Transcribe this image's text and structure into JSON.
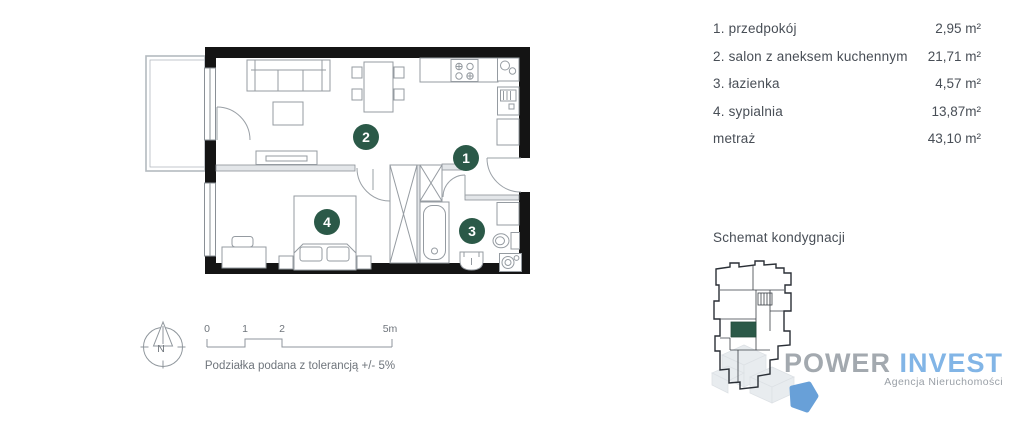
{
  "colors": {
    "accent_green": "#2b5948",
    "wall_black": "#141414",
    "furniture_gray": "#959ba1",
    "logo_gray": "#a3a9af",
    "logo_blue": "#82b5e6",
    "schematic_blue_shape": "#68a0d8"
  },
  "plan": {
    "room_markers": [
      {
        "num": "1"
      },
      {
        "num": "2"
      },
      {
        "num": "3"
      },
      {
        "num": "4"
      }
    ]
  },
  "legend": {
    "rows": [
      {
        "label": "1. przedpokój",
        "value": "2,95 m²"
      },
      {
        "label": "2. salon z aneksem kuchennym",
        "value": "21,71 m²"
      },
      {
        "label": "3. łazienka",
        "value": "4,57 m²"
      },
      {
        "label": "4. sypialnia",
        "value": "13,87m²"
      },
      {
        "label": "metraż",
        "value": "43,10 m²"
      }
    ]
  },
  "scalebar": {
    "ticks": [
      "0",
      "1",
      "2",
      "5m"
    ],
    "caption": "Podziałka podana z tolerancją +/- 5%"
  },
  "compass": {
    "label": "N"
  },
  "schematic": {
    "title": "Schemat kondygnacji"
  },
  "logo": {
    "primary": "POWER",
    "secondary": "INVEST",
    "subtitle": "Agencja Nieruchomości"
  }
}
